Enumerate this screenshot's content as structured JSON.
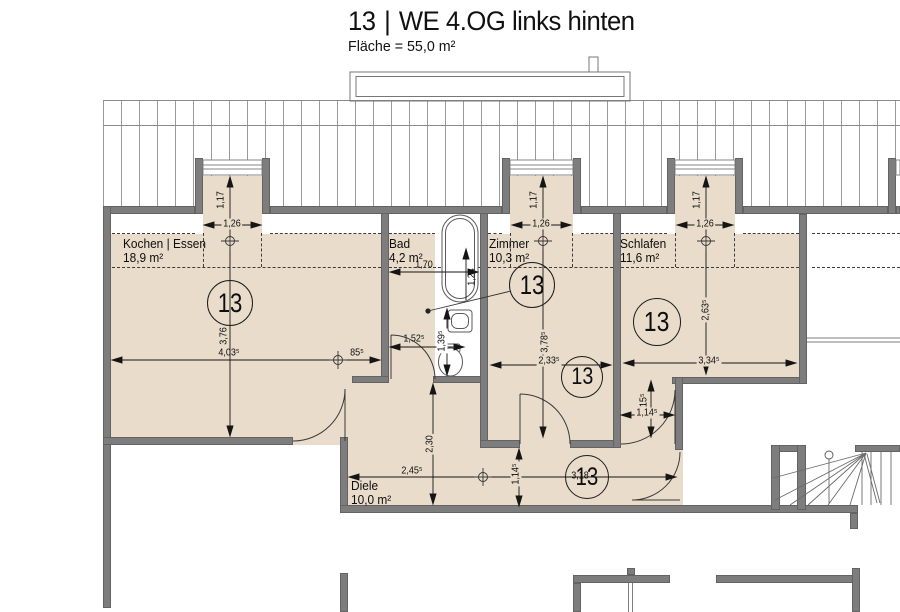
{
  "colors": {
    "floor_beige": "#e9dccb",
    "wall_gray": "#7d7d7d",
    "line_dark": "#111111"
  },
  "header": {
    "unit_number": "13",
    "separator": "|",
    "title": "WE 4.OG links hinten",
    "area_label": "Fläche = 55,0 m²"
  },
  "unit": {
    "number": "13"
  },
  "rooms": [
    {
      "name": "Kochen | Essen",
      "area": "18,9 m²"
    },
    {
      "name": "Bad",
      "area": "4,2 m²"
    },
    {
      "name": "Zimmer",
      "area": "10,3 m²"
    },
    {
      "name": "Schlafen",
      "area": "11,6 m²"
    },
    {
      "name": "Diele",
      "area": "10,0 m²"
    }
  ],
  "dims": [
    "1,17",
    "1,26",
    "1,17",
    "1,26",
    "1,17",
    "1,26",
    "3,76",
    "4,03⁵",
    "85⁵",
    "1,70",
    "1,24",
    "1,52⁵",
    "1,39⁵",
    "3,78⁵",
    "2,33⁵",
    "2,63⁵",
    "3,34⁵",
    "1,15⁵",
    "1,14⁵",
    "2,30",
    "2,45⁵",
    "3,18",
    "1,14⁵"
  ]
}
